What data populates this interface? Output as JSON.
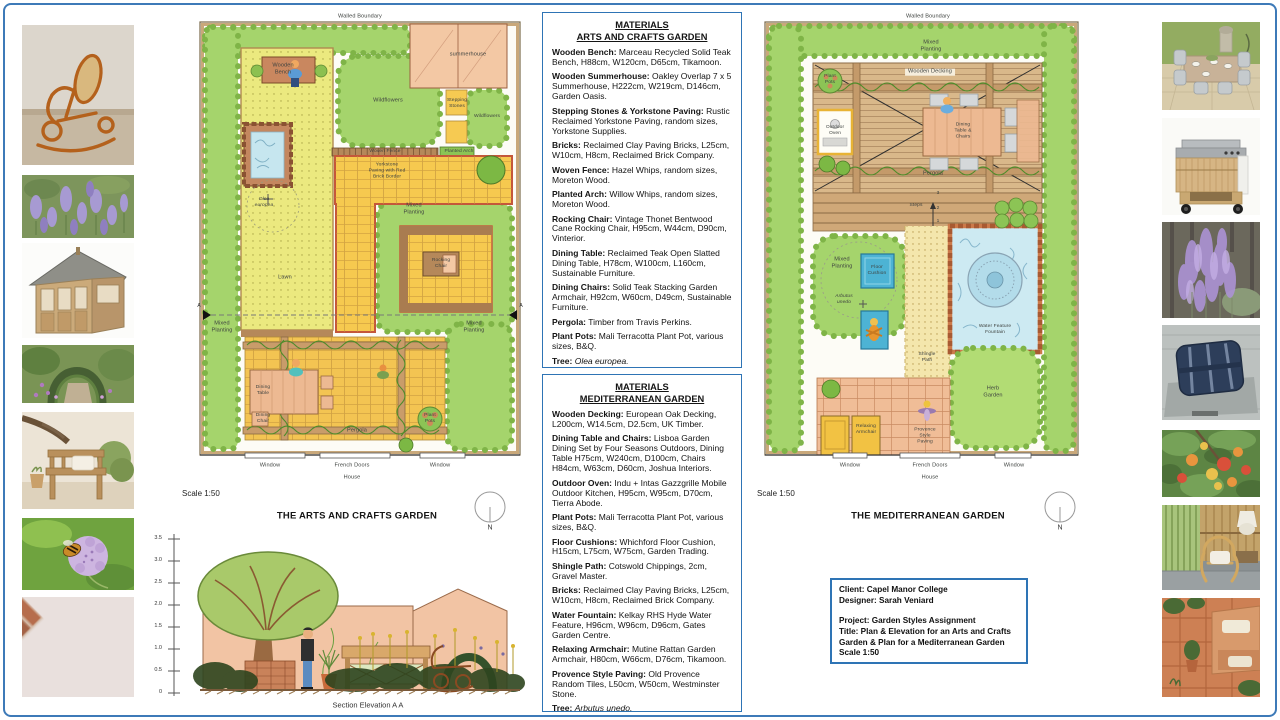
{
  "board": {
    "border_color": "#2e74b5"
  },
  "photo_strips": {
    "left": [
      "rocking-chair",
      "lavender",
      "wooden-summerhouse",
      "garden-arch",
      "wooden-bench",
      "scabious-flower",
      "reclaimed-bricks"
    ],
    "right": [
      "outdoor-dining-set",
      "outdoor-kitchen",
      "perovskia-bush",
      "floor-cushion",
      "arbutus-fruit-tree",
      "rattan-armchair",
      "terracotta-paving"
    ]
  },
  "materials_arts": {
    "heading_line1": "MATERIALS",
    "heading_line2": "ARTS AND CRAFTS GARDEN",
    "items": [
      {
        "label": "Wooden Bench:",
        "text": "Marceau Recycled Solid Teak Bench, H88cm, W120cm, D65cm, Tikamoon."
      },
      {
        "label": "Wooden Summerhouse:",
        "text": "Oakley Overlap 7 x 5 Summerhouse, H222cm, W219cm, D146cm, Garden Oasis."
      },
      {
        "label": "Stepping Stones & Yorkstone Paving:",
        "text": "Rustic Reclaimed Yorkstone Paving, random sizes, Yorkstone Supplies."
      },
      {
        "label": "Bricks:",
        "text": "Reclaimed Clay Paving Bricks, L25cm, W10cm, H8cm, Reclaimed Brick Company."
      },
      {
        "label": "Woven Fence:",
        "text": "Hazel Whips, random sizes, Moreton Wood."
      },
      {
        "label": "Planted Arch:",
        "text": "Willow Whips, random sizes, Moreton Wood."
      },
      {
        "label": "Rocking Chair:",
        "text": "Vintage Thonet Bentwood Cane Rocking Chair, H95cm, W44cm,  D90cm, Vinterior."
      },
      {
        "label": "Dining Table:",
        "text": "Reclaimed Teak Open Slatted Dining Table, H78cm, W100cm, L160cm, Sustainable Furniture."
      },
      {
        "label": "Dining Chairs:",
        "text": "Solid Teak Stacking Garden Armchair, H92cm, W60cm, D49cm, Sustainable Furniture."
      },
      {
        "label": "Pergola:",
        "text": "Timber from Travis Perkins."
      },
      {
        "label": "Plant Pots:",
        "text": "Mali Terracotta Plant Pot, various sizes, B&Q."
      },
      {
        "label": "Tree:",
        "text": "Olea europea.",
        "italic": true
      }
    ]
  },
  "materials_med": {
    "heading_line1": "MATERIALS",
    "heading_line2": "MEDITERRANEAN GARDEN",
    "items": [
      {
        "label": "Wooden Decking:",
        "text": "European Oak Decking, L200cm, W14.5cm, D2.5cm, UK Timber."
      },
      {
        "label": "Dining Table and Chairs:",
        "text": "Lisboa Garden Dining Set by Four Seasons Outdoors, Dining Table H75cm, W240cm, D100cm, Chairs H84cm, W63cm, D60cm, Joshua Interiors."
      },
      {
        "label": "Outdoor Oven:",
        "text": "Indu + Intas Gazzgrille Mobile Outdoor Kitchen, H95cm, W95cm, D70cm, Tierra Abode."
      },
      {
        "label": "Plant Pots:",
        "text": "Mali Terracotta Plant Pot, various sizes, B&Q."
      },
      {
        "label": "Floor Cushions:",
        "text": "Whichford Floor Cushion, H15cm, L75cm, W75cm, Garden Trading."
      },
      {
        "label": "Shingle Path:",
        "text": "Cotswold Chippings, 2cm, Gravel Master."
      },
      {
        "label": "Bricks:",
        "text": "Reclaimed Clay Paving Bricks, L25cm, W10cm, H8cm, Reclaimed Brick Company."
      },
      {
        "label": "Water Fountain:",
        "text": "Kelkay RHS Hyde Water Feature, H96cm, W96cm, D96cm, Gates Garden Centre."
      },
      {
        "label": "Relaxing Armchair:",
        "text": "Mutine Rattan Garden Armchair, H80cm, W66cm, D76cm, Tikamoon."
      },
      {
        "label": "Provence Style Paving:",
        "text": "Old Provence Random Tiles, L50cm, W50cm, Westminster Stone."
      },
      {
        "label": "Tree:",
        "text": "Arbutus unedo.",
        "italic": true
      }
    ]
  },
  "plan_arts": {
    "boundary": "Walled  Boundary",
    "scale": "Scale 1:50",
    "title": "THE ARTS AND CRAFTS GARDEN",
    "north": "N",
    "section_marker": "A",
    "labels": {
      "wooden_bench": "Wooden\nBench",
      "summerhouse": "summerhouse",
      "wildflowers_center": "Wildflowers",
      "stepping_stones": "Stepping\nStones",
      "wildflowers_right": "Wildflowers",
      "woven_fence": "Woven Fence",
      "planted_arch": "Planted Arch",
      "yorkstone": "Yorkstone\nPaving with Red\nBrick Border",
      "olea": "Olea\neuropea",
      "lawn": "Lawn",
      "mixed_planting_nook": "Mixed\nPlanting",
      "rocking_chair": "Rocking\nChair",
      "mixed_planting_left": "Mixed\nPlanting",
      "mixed_planting_right": "Mixed\nPlanting",
      "dining_table": "Dining\nTable",
      "dining_chair": "Dining\nChair",
      "pergola": "Pergola",
      "plant_pots": "Plant\nPots",
      "window_left": "Window",
      "french_doors": "French Doors",
      "window_right": "Window",
      "house": "House"
    }
  },
  "plan_med": {
    "boundary": "Walled  Boundary",
    "scale": "Scale 1:50",
    "title": "THE MEDITERRANEAN GARDEN",
    "north": "N",
    "labels": {
      "mixed_planting_top": "Mixed\nPlanting",
      "wooden_decking": "Wooden Decking",
      "plant_pots": "Plant\nPots",
      "outdoor_oven": "Outdoor\nOven",
      "dining_set": "Dining\nTable &\nChairs",
      "pergola": "Pergola",
      "steps": "Steps",
      "step_1": "1",
      "step_2": "2",
      "step_3": "3",
      "mixed_planting_left": "Mixed\nPlanting",
      "floor_cushion": "Floor\nCushion",
      "arbutus": "Arbutus\nunedo",
      "shingle_path": "Shingle\nPath",
      "fountain": "Water Feature\nFountain",
      "herb_garden": "Herb\nGarden",
      "relaxing_armchair": "Relaxing\nArmchair",
      "provence_paving": "Provence\nStyle\nPaving",
      "window_left": "Window",
      "french_doors": "French Doors",
      "window_right": "Window",
      "house": "House"
    }
  },
  "elevation": {
    "ticks": [
      "3.5",
      "3.0",
      "2.5",
      "2.0",
      "1.5",
      "1.0",
      "0.5",
      "0"
    ],
    "caption": "Section Elevation A A"
  },
  "client_box": {
    "lines": [
      "Client: Capel Manor College",
      "Designer: Sarah Veniard",
      "Project: Garden Styles Assignment",
      "Title: Plan & Elevation for an Arts and Crafts Garden & Plan for a Mediterranean Garden",
      "Scale 1:50"
    ]
  }
}
